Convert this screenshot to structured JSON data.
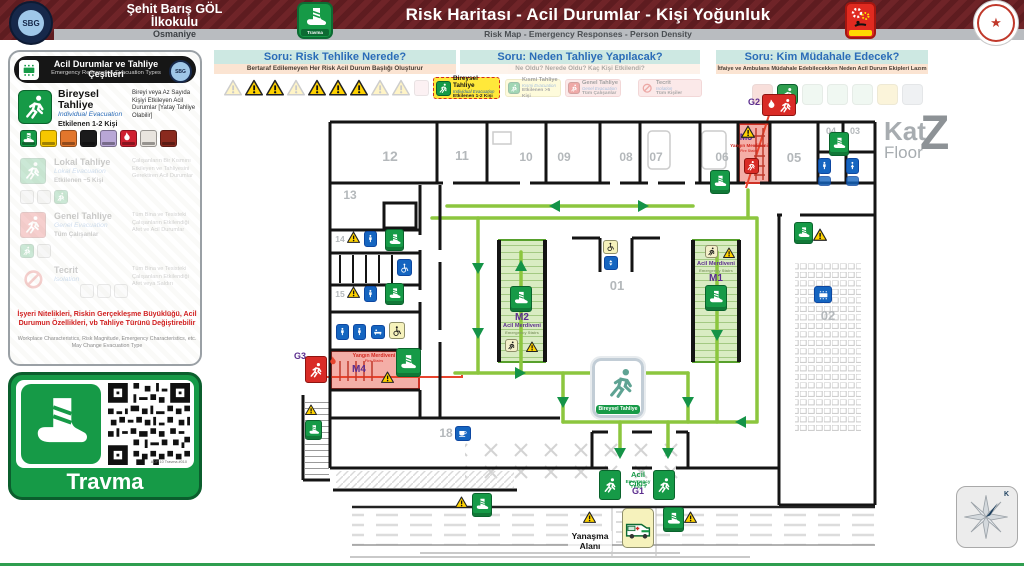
{
  "colors": {
    "accent_green": "#169a47",
    "route_green": "#8cc63e",
    "maroon": "#6f2428",
    "danger_red": "#d92b26",
    "purple": "#5b2d8e",
    "warn_yellow": "#ffd200",
    "teal_bar": "#cde8e2",
    "orange_bar": "#fbe4d2",
    "wc_blue": "#1565c0"
  },
  "header": {
    "school_line1": "Şehit Barış GÖL",
    "school_line2": "İlkokulu",
    "city": "Osmaniye",
    "logo_text": "SBG",
    "app_label": "Travma",
    "title": "Risk Haritası - Acil Durumlar - Kişi Yoğunluk",
    "subtitle": "Risk Map - Emergency Responses - Person Density"
  },
  "sidebar": {
    "title": "Acil Durumlar ve Tahliye Çeşitleri",
    "subtitle": "Emergency Response & Evacuation Types",
    "bireysel": {
      "name": "Bireysel Tahliye",
      "name_en": "Individual Evacuation",
      "affected": "Etkilenen 1-2 Kişi",
      "desc": "Bireyi veya Az Sayıda Kişiyi Etkileyen Acil Durumlar [Yatay Tahliye Olabilir]"
    },
    "lokal": {
      "name": "Lokal Tahliye",
      "name_en": "Lokal Evacuation",
      "affected": "Etkilenen ~5 Kişi",
      "desc": "Çalışanların Bir Kısmını Etkileyen ve Tahliyesini Gerektiren Acil Durumlar"
    },
    "genel": {
      "name": "Genel Tahliye",
      "name_en": "Genel Evacuation",
      "affected": "Tüm Çalışanlar",
      "desc": "Tüm Bina ve Tesisteki Çalışanların Etkilendiği Afet ve Acil Durumlar"
    },
    "tecrit": {
      "name": "Tecrit",
      "name_en": "Isolation",
      "affected": "",
      "desc": "Tüm Bina ve Tesisteki Çalışanların Etkilendiği Afet veya Saldırı"
    },
    "note_tr": "İşyeri Nitelikleri, Riskin Gerçekleşme Büyüklüğü, Acil Durumun Özellikleri, vb Tahliye Türünü Değiştirebilir",
    "note_en": "Workplace Characteristics, Risk Magnitude, Emergency Characteristics, etc. May Change Evacuation Type",
    "trauma_card": {
      "label": "Travma",
      "qr_caption": "ADP 10 Travma #010"
    }
  },
  "questions": {
    "q1": {
      "title": "Soru: Risk Tehlike Nerede?",
      "subtitle": "Bertaraf Edilemeyen Her Risk Acil Durum Başlığı Oluşturur"
    },
    "q2": {
      "title": "Soru: Neden Tahliye Yapılacak?",
      "subtitle": "Ne Oldu? Nerede Oldu? Kaç Kişi Etkilendi?",
      "options": [
        {
          "name": "Bireysel Tahliye",
          "name_en": "Individual Evacuation",
          "affected": "Etkilenen 1-2 Kişi"
        },
        {
          "name": "Kısmi Tahliye",
          "name_en": "Kısmi Evacuation",
          "affected": "Etkilenen >5 Kişi"
        },
        {
          "name": "Genel Tahliye",
          "name_en": "Genel Evacuation",
          "affected": "Tüm Çalışanlar"
        },
        {
          "name": "Tecrit",
          "name_en": "Isolation",
          "affected": "Tüm Kişiler"
        }
      ]
    },
    "q3": {
      "title": "Soru: Kim Müdahale Edecek?",
      "subtitle": "İtfaiye ve Ambulans Müdahale Edebilecekken Neden Acil Durum Ekipleri Lazım"
    }
  },
  "plan": {
    "floor": {
      "kat": "Kat",
      "floor": "Floor",
      "code": "Z"
    },
    "rooms": {
      "r01": "01",
      "r02": "02",
      "r03": "03",
      "r04": "04",
      "r05": "05",
      "r06": "06",
      "r07": "07",
      "r08": "08",
      "r09": "09",
      "r10": "10",
      "r11": "11",
      "r12": "12",
      "r13": "13",
      "r14": "14",
      "r15": "15",
      "r18": "18"
    },
    "m1": {
      "code": "M1",
      "name": "Acil Merdiveni",
      "name_en": "Emergency Stairs"
    },
    "m2": {
      "code": "M2",
      "name": "Acil Merdiveni",
      "name_en": "Emergency Stairs"
    },
    "m3": {
      "code": "M3",
      "name": "Yangın Merdiveni",
      "name_en": "Fire Stairs"
    },
    "m4": {
      "code": "M4",
      "name": "Yangın Merdiveni",
      "name_en": "Fire Stairs"
    },
    "g1": {
      "code": "G1",
      "name": "Acil Çıkış",
      "name_en": "Emergency Exit"
    },
    "g2": {
      "code": "G2"
    },
    "g3": {
      "code": "G3"
    },
    "evac_badge": "Bireysel Tahliye",
    "yanasma_line1": "Yanaşma",
    "yanasma_line2": "Alanı",
    "compass_north": "K"
  }
}
